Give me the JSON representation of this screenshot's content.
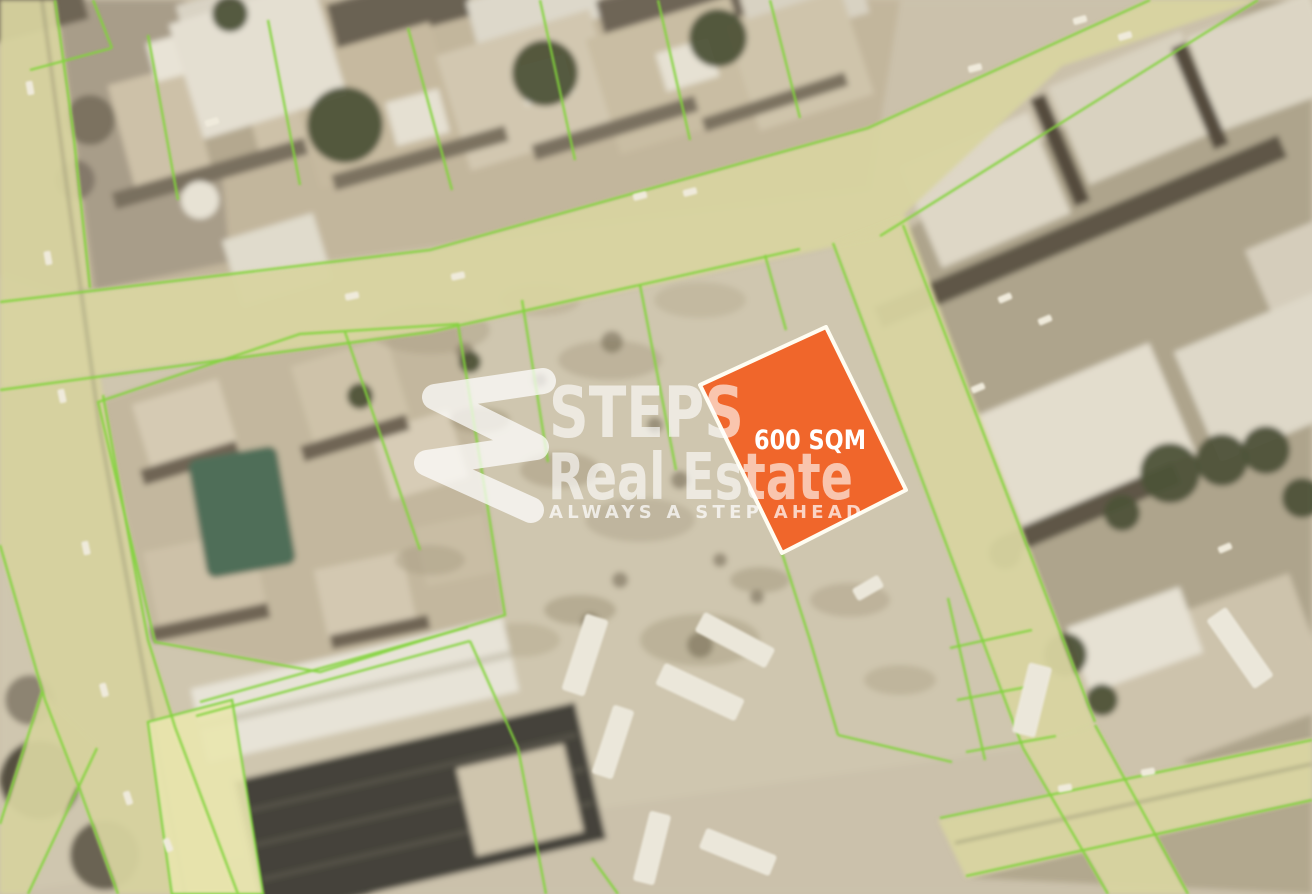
{
  "map": {
    "type": "satellite-aerial-parcel-map",
    "highlight_plot": {
      "area_label": "600 SQM",
      "fill_color": "#F0662B",
      "border_color": "#FFFDF2"
    },
    "watermark": {
      "logo": "steps-s-logo",
      "line1": "STEPS",
      "line2": "Real Estate",
      "tagline": "ALWAYS A STEP AHEAD",
      "text_color": "#FFFFFF"
    },
    "overlay_colors": {
      "parcel_boundary_line": "#82D43C",
      "road_tint": "#D8D4A0",
      "highlighted_side_parcel": "#E9E5AE",
      "ground": "#CBC1AB"
    }
  }
}
